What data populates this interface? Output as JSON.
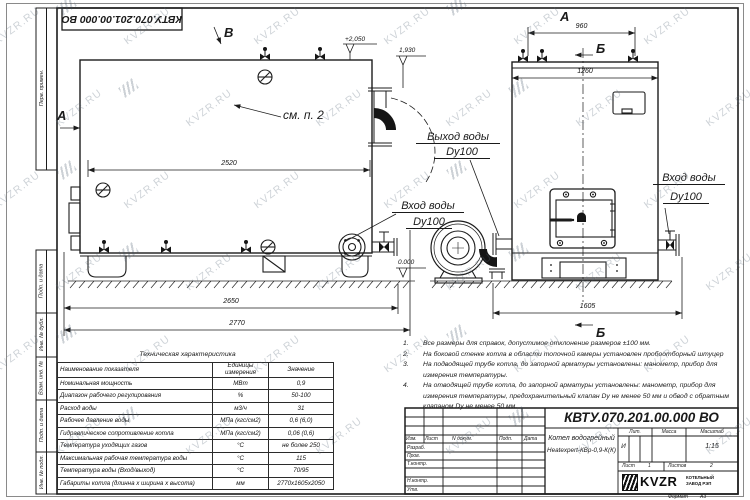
{
  "sheet": {
    "doc_number": "КВТУ.070.201.00.000  ВО",
    "watermark": "KVZR.RU",
    "format_label": "Формат",
    "format_value": "А3",
    "stamp_side_labels": [
      "Перв. примен.",
      "Подп. и дата",
      "Инв. № дубл.",
      "Взам. инв. №",
      "Подп. и дата",
      "Инв. № подл."
    ]
  },
  "drawing": {
    "markers": {
      "a_side": "А",
      "v_side": "В",
      "a_end": "А",
      "b_top": "Б",
      "b_bottom": "Б"
    },
    "callouts": {
      "see_note": "см. п. 2",
      "outlet_line1": "Выход воды",
      "outlet_line2": "Dy100",
      "inlet_side_line1": "Вход воды",
      "inlet_side_line2": "Dy100",
      "inlet_end_line1": "Вход воды",
      "inlet_end_line2": "Dy100"
    },
    "levels": {
      "top": "+2,050",
      "outlet": "1,930",
      "zero": "0.000"
    },
    "dims": {
      "d2520": "2520",
      "d2650": "2650",
      "d2770": "2770",
      "d960": "960",
      "d1260": "1260",
      "d1605": "1605"
    }
  },
  "notes": {
    "items": [
      {
        "num": "1.",
        "text": "Все размеры для справок, допустимое отклонение размеров ±100 мм."
      },
      {
        "num": "2.",
        "text": "На боковой стенке котла в области топочной камеры установлен пробоотборный штуцер"
      },
      {
        "num": "3.",
        "text": "На  подводящей трубе котла, до запорной арматуры установлены: манометр, прибор для измерения температуры."
      },
      {
        "num": "4.",
        "text": "На отводящей трубе котла, до запорной арматуры установлены: манометр, прибор для измерения температуры, предохранительный клапан Dу не менее 50 мм и обвод с обратным клапаном Dу не менее 50 мм."
      }
    ]
  },
  "spec_table": {
    "title": "Техническая характеристика",
    "col_name": "Наименование показателя",
    "col_units": "Единицы измерения",
    "col_value": "Значение",
    "rows": [
      {
        "name": "Номинальная мощность",
        "units": "МВт",
        "value": "0,9"
      },
      {
        "name": "Диапазон рабочего регулирования",
        "units": "%",
        "value": "50-100"
      },
      {
        "name": "Расход воды",
        "units": "м3/ч",
        "value": "31"
      },
      {
        "name": "Рабочее давление воды",
        "units": "МПа (кгс/см2)",
        "value": "0,6 (6,0)"
      },
      {
        "name": "Гидравлическое сопротивление котла",
        "units": "МПа (кгс/см2)",
        "value": "0,06 (0,6)"
      },
      {
        "name": "Температура уходящих газов",
        "units": "°С",
        "value": "не более 250"
      },
      {
        "name": "Максимальная рабочая температура воды",
        "units": "°С",
        "value": "115"
      },
      {
        "name": "Температура воды (Вход/выход)",
        "units": "°С",
        "value": "70/95"
      },
      {
        "name": "Габариты котла (длинна х ширина х высота)",
        "units": "мм",
        "value": "2770х1605х2050"
      }
    ]
  },
  "titleblock": {
    "doc_number": "КВТУ.070.201.00.000  ВО",
    "product_line1": "Котел водогрейный",
    "product_line2": "Heatexpert-КВр-0,9-К(К)",
    "cols": {
      "izm": "Изм.",
      "list": "Лист",
      "doc": "N докум.",
      "sign": "Подп.",
      "date": "Дата"
    },
    "rows": [
      "Разраб.",
      "Пров.",
      "Т.контр.",
      "",
      "Н.контр.",
      "Утв."
    ],
    "lit_header": "Лит.",
    "mass_header": "Масса",
    "scale_header": "Масштаб",
    "lit_value": "И",
    "scale_value": "1:15",
    "sheet_label": "Лист",
    "sheet_value": "1",
    "sheets_label": "Листов",
    "sheets_value": "2",
    "company_name": "KVZR",
    "company_sub1": "КОТЕЛЬНЫЙ",
    "company_sub2": "ЗАВОД РЭП"
  }
}
